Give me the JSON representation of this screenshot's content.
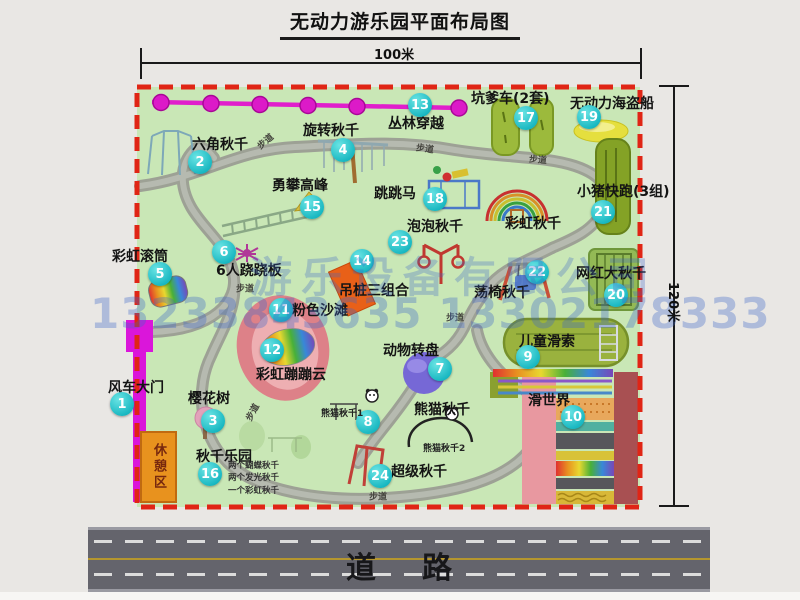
{
  "title": "无动力游乐园平面布局图",
  "dimensions": {
    "width_label": "100米",
    "height_label": "120米"
  },
  "road": {
    "label": "道路"
  },
  "watermark": {
    "company": "游乐设备有限公司",
    "phones": "13233843635 13302178333"
  },
  "map": {
    "rest_area_label": "休憩区",
    "path_label_text": "步道",
    "path_labels": [
      {
        "x": 265,
        "y": 141,
        "r": -40
      },
      {
        "x": 425,
        "y": 148,
        "r": 8
      },
      {
        "x": 538,
        "y": 159,
        "r": 5
      },
      {
        "x": 245,
        "y": 288,
        "r": 0
      },
      {
        "x": 455,
        "y": 317,
        "r": 0
      },
      {
        "x": 252,
        "y": 412,
        "r": -62
      },
      {
        "x": 378,
        "y": 496,
        "r": 0
      }
    ],
    "attractions": [
      {
        "id": "windmill-gate",
        "num": 1,
        "label": "风车大门",
        "badge": [
          122,
          404
        ],
        "label_pos": [
          108,
          381
        ]
      },
      {
        "id": "hex-swing",
        "num": 2,
        "label": "六角秋千",
        "badge": [
          200,
          162
        ],
        "label_pos": [
          192,
          138
        ]
      },
      {
        "id": "cherry-tree",
        "num": 3,
        "label": "樱花树",
        "badge": [
          213,
          421
        ],
        "label_pos": [
          188,
          392
        ]
      },
      {
        "id": "rotary-swing",
        "num": 4,
        "label": "旋转秋千",
        "badge": [
          343,
          150
        ],
        "label_pos": [
          303,
          124
        ]
      },
      {
        "id": "rainbow-roller",
        "num": 5,
        "label": "彩虹滚筒",
        "badge": [
          160,
          274
        ],
        "label_pos": [
          112,
          250
        ]
      },
      {
        "id": "six-seesaw",
        "num": 6,
        "label": "6人跷跷板",
        "badge": [
          224,
          252
        ],
        "label_pos": [
          216,
          264
        ]
      },
      {
        "id": "animal-turntable",
        "num": 7,
        "label": "动物转盘",
        "badge": [
          440,
          369
        ],
        "label_pos": [
          383,
          344
        ]
      },
      {
        "id": "panda-swing",
        "num": 8,
        "label": "熊猫秋千",
        "badge": [
          368,
          422
        ],
        "label_pos": [
          414,
          403
        ],
        "subs": [
          {
            "text": "熊猫秋千1",
            "pos": [
              321,
              406
            ]
          },
          {
            "text": "熊猫秋千2",
            "pos": [
              423,
              441
            ]
          }
        ]
      },
      {
        "id": "kids-zipline",
        "num": 9,
        "label": "儿童滑索",
        "badge": [
          528,
          357
        ],
        "label_pos": [
          519,
          335
        ]
      },
      {
        "id": "slide-world",
        "num": 10,
        "label": "滑世界",
        "badge": [
          573,
          417
        ],
        "label_pos": [
          528,
          394
        ]
      },
      {
        "id": "pink-beach",
        "num": 11,
        "label": "粉色沙滩",
        "badge": [
          281,
          310
        ],
        "label_pos": [
          292,
          304
        ]
      },
      {
        "id": "rainbow-cloud",
        "num": 12,
        "label": "彩虹蹦蹦云",
        "badge": [
          272,
          350
        ],
        "label_pos": [
          256,
          368
        ]
      },
      {
        "id": "jungle-crossing",
        "num": 13,
        "label": "丛林穿越",
        "badge": [
          420,
          105
        ],
        "label_pos": [
          388,
          117
        ]
      },
      {
        "id": "hanging-posts",
        "num": 14,
        "label": "吊桩三组合",
        "badge": [
          362,
          261
        ],
        "label_pos": [
          339,
          284
        ]
      },
      {
        "id": "peak-climb",
        "num": 15,
        "label": "勇攀高峰",
        "badge": [
          312,
          207
        ],
        "label_pos": [
          272,
          179
        ]
      },
      {
        "id": "swing-park",
        "num": 16,
        "label": "秋千乐园",
        "badge": [
          210,
          474
        ],
        "label_pos": [
          196,
          450
        ],
        "notes": [
          "两个蝴蝶秋千",
          "两个发光秋千",
          "一个彩虹秋千"
        ],
        "notes_pos": [
          228,
          460
        ]
      },
      {
        "id": "kengdie-car",
        "num": 17,
        "label": "坑爹车(2套)",
        "badge": [
          526,
          118
        ],
        "label_pos": [
          471,
          92
        ]
      },
      {
        "id": "jump-horse",
        "num": 18,
        "label": "跳跳马",
        "badge": [
          435,
          199
        ],
        "label_pos": [
          374,
          187
        ]
      },
      {
        "id": "pirate-ship",
        "num": 19,
        "label": "无动力海盗船",
        "badge": [
          589,
          117
        ],
        "label_pos": [
          570,
          97
        ]
      },
      {
        "id": "big-swing",
        "num": 20,
        "label": "网红大秋千",
        "badge": [
          616,
          295
        ],
        "label_pos": [
          576,
          267
        ]
      },
      {
        "id": "piggy-run",
        "num": 21,
        "label": "小猪快跑(3组)",
        "badge": [
          603,
          212
        ],
        "label_pos": [
          577,
          185
        ]
      },
      {
        "id": "chair-swing",
        "num": 22,
        "label": "荡椅秋千",
        "badge": [
          537,
          272
        ],
        "label_pos": [
          474,
          286
        ]
      },
      {
        "id": "bubble-swing",
        "num": 23,
        "label": "泡泡秋千",
        "badge": [
          400,
          242
        ],
        "label_pos": [
          407,
          220
        ]
      },
      {
        "id": "super-swing",
        "num": 24,
        "label": "超级秋千",
        "badge": [
          380,
          476
        ],
        "label_pos": [
          391,
          465
        ]
      },
      {
        "id": "rainbow-swing",
        "num": null,
        "label": "彩虹秋千",
        "badge": null,
        "label_pos": [
          505,
          217
        ]
      }
    ]
  }
}
